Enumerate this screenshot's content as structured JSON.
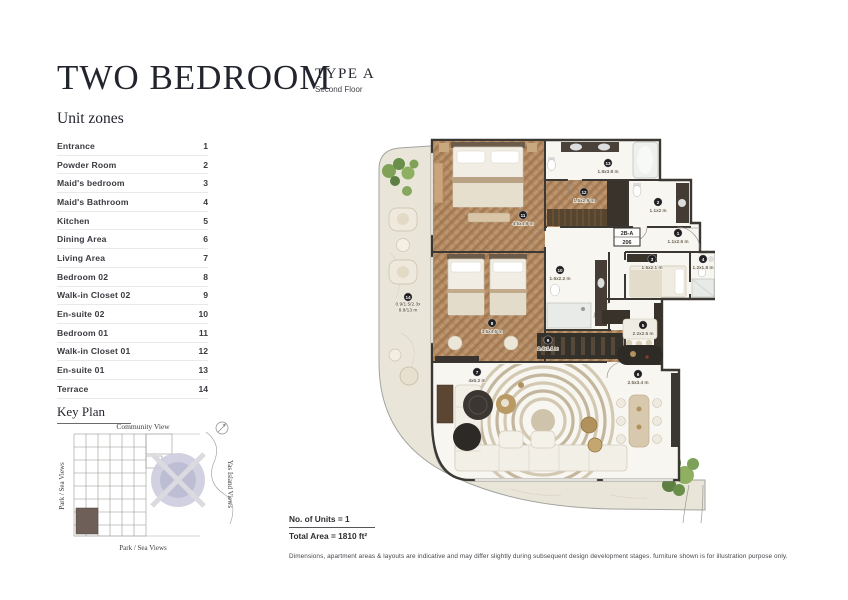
{
  "header": {
    "title": "TWO BEDROOM",
    "type_label": "TYPE A",
    "floor_label": "Second Floor"
  },
  "unit_zones": {
    "heading": "Unit zones",
    "items": [
      {
        "label": "Entrance",
        "num": "1"
      },
      {
        "label": "Powder Room",
        "num": "2"
      },
      {
        "label": "Maid's bedroom",
        "num": "3"
      },
      {
        "label": "Maid's Bathroom",
        "num": "4"
      },
      {
        "label": "Kitchen",
        "num": "5"
      },
      {
        "label": "Dining Area",
        "num": "6"
      },
      {
        "label": "Living Area",
        "num": "7"
      },
      {
        "label": "Bedroom 02",
        "num": "8"
      },
      {
        "label": "Walk-in Closet 02",
        "num": "9"
      },
      {
        "label": "En-suite 02",
        "num": "10"
      },
      {
        "label": "Bedroom 01",
        "num": "11"
      },
      {
        "label": "Walk-in Closet 01",
        "num": "12"
      },
      {
        "label": "En-suite 01",
        "num": "13"
      },
      {
        "label": "Terrace",
        "num": "14"
      }
    ]
  },
  "key_plan": {
    "heading": "Key Plan",
    "top_label": "Community View",
    "left_label": "Park / Sea Views",
    "right_label": "Yas Island Views",
    "bottom_label": "Park / Sea Views",
    "highlight_color": "#6e6058",
    "lagoon_color": "#c9c9dd"
  },
  "floor_plan": {
    "unit_badge_line1": "2B-A",
    "unit_badge_line2": "206",
    "colors": {
      "wall": "#3b3833",
      "wood": "#b38b64",
      "terrace": "#e9e5d9",
      "marker": "#211f22"
    },
    "rooms": [
      {
        "num": "1",
        "name": "Entrance",
        "dims": "1.1x2.6 m",
        "x": 307,
        "y": 100
      },
      {
        "num": "2",
        "name": "Powder Room",
        "dims": "1.1x2 m",
        "x": 287,
        "y": 69
      },
      {
        "num": "3",
        "name": "Maid's bedroom",
        "dims": "1.5x2.1 m",
        "x": 281,
        "y": 126
      },
      {
        "num": "4",
        "name": "Maid's Bathroom",
        "dims": "1.2x1.8 m",
        "x": 332,
        "y": 126
      },
      {
        "num": "5",
        "name": "Kitchen",
        "dims": "2.2x2.6 m",
        "x": 272,
        "y": 192
      },
      {
        "num": "6",
        "name": "Dining Area",
        "dims": "2.5x3.4 m",
        "x": 267,
        "y": 241
      },
      {
        "num": "7",
        "name": "Living Area",
        "dims": "4x6.2 m",
        "x": 106,
        "y": 239
      },
      {
        "num": "8",
        "name": "Bedroom 02",
        "dims": "3.5x4.5 m",
        "x": 121,
        "y": 190
      },
      {
        "num": "9",
        "name": "Walk-in Closet 02",
        "dims": "2.4x1.1 m",
        "x": 177,
        "y": 207
      },
      {
        "num": "10",
        "name": "En-suite 02",
        "dims": "1.6x2.2 m",
        "x": 189,
        "y": 137
      },
      {
        "num": "11",
        "name": "Bedroom 01",
        "dims": "4.5x4.8 m",
        "x": 152,
        "y": 82
      },
      {
        "num": "12",
        "name": "Walk-in Closet 01",
        "dims": "1.5x2.9 m",
        "x": 213,
        "y": 59
      },
      {
        "num": "13",
        "name": "En-suite 01",
        "dims": "1.8x3.8 m",
        "x": 237,
        "y": 30
      },
      {
        "num": "14",
        "name": "Terrace",
        "dims": "0.9/1.5/2.3x",
        "dims2": "8.8/13 m",
        "x": 37,
        "y": 164
      }
    ]
  },
  "summary": {
    "units_label": "No. of Units = 1",
    "area_label": "Total Area = 1810 ft²"
  },
  "disclaimer": "Dimensions, apartment areas & layouts are indicative and may differ slightly during subsequent design development stages. furniture shown is for illustration purpose only."
}
